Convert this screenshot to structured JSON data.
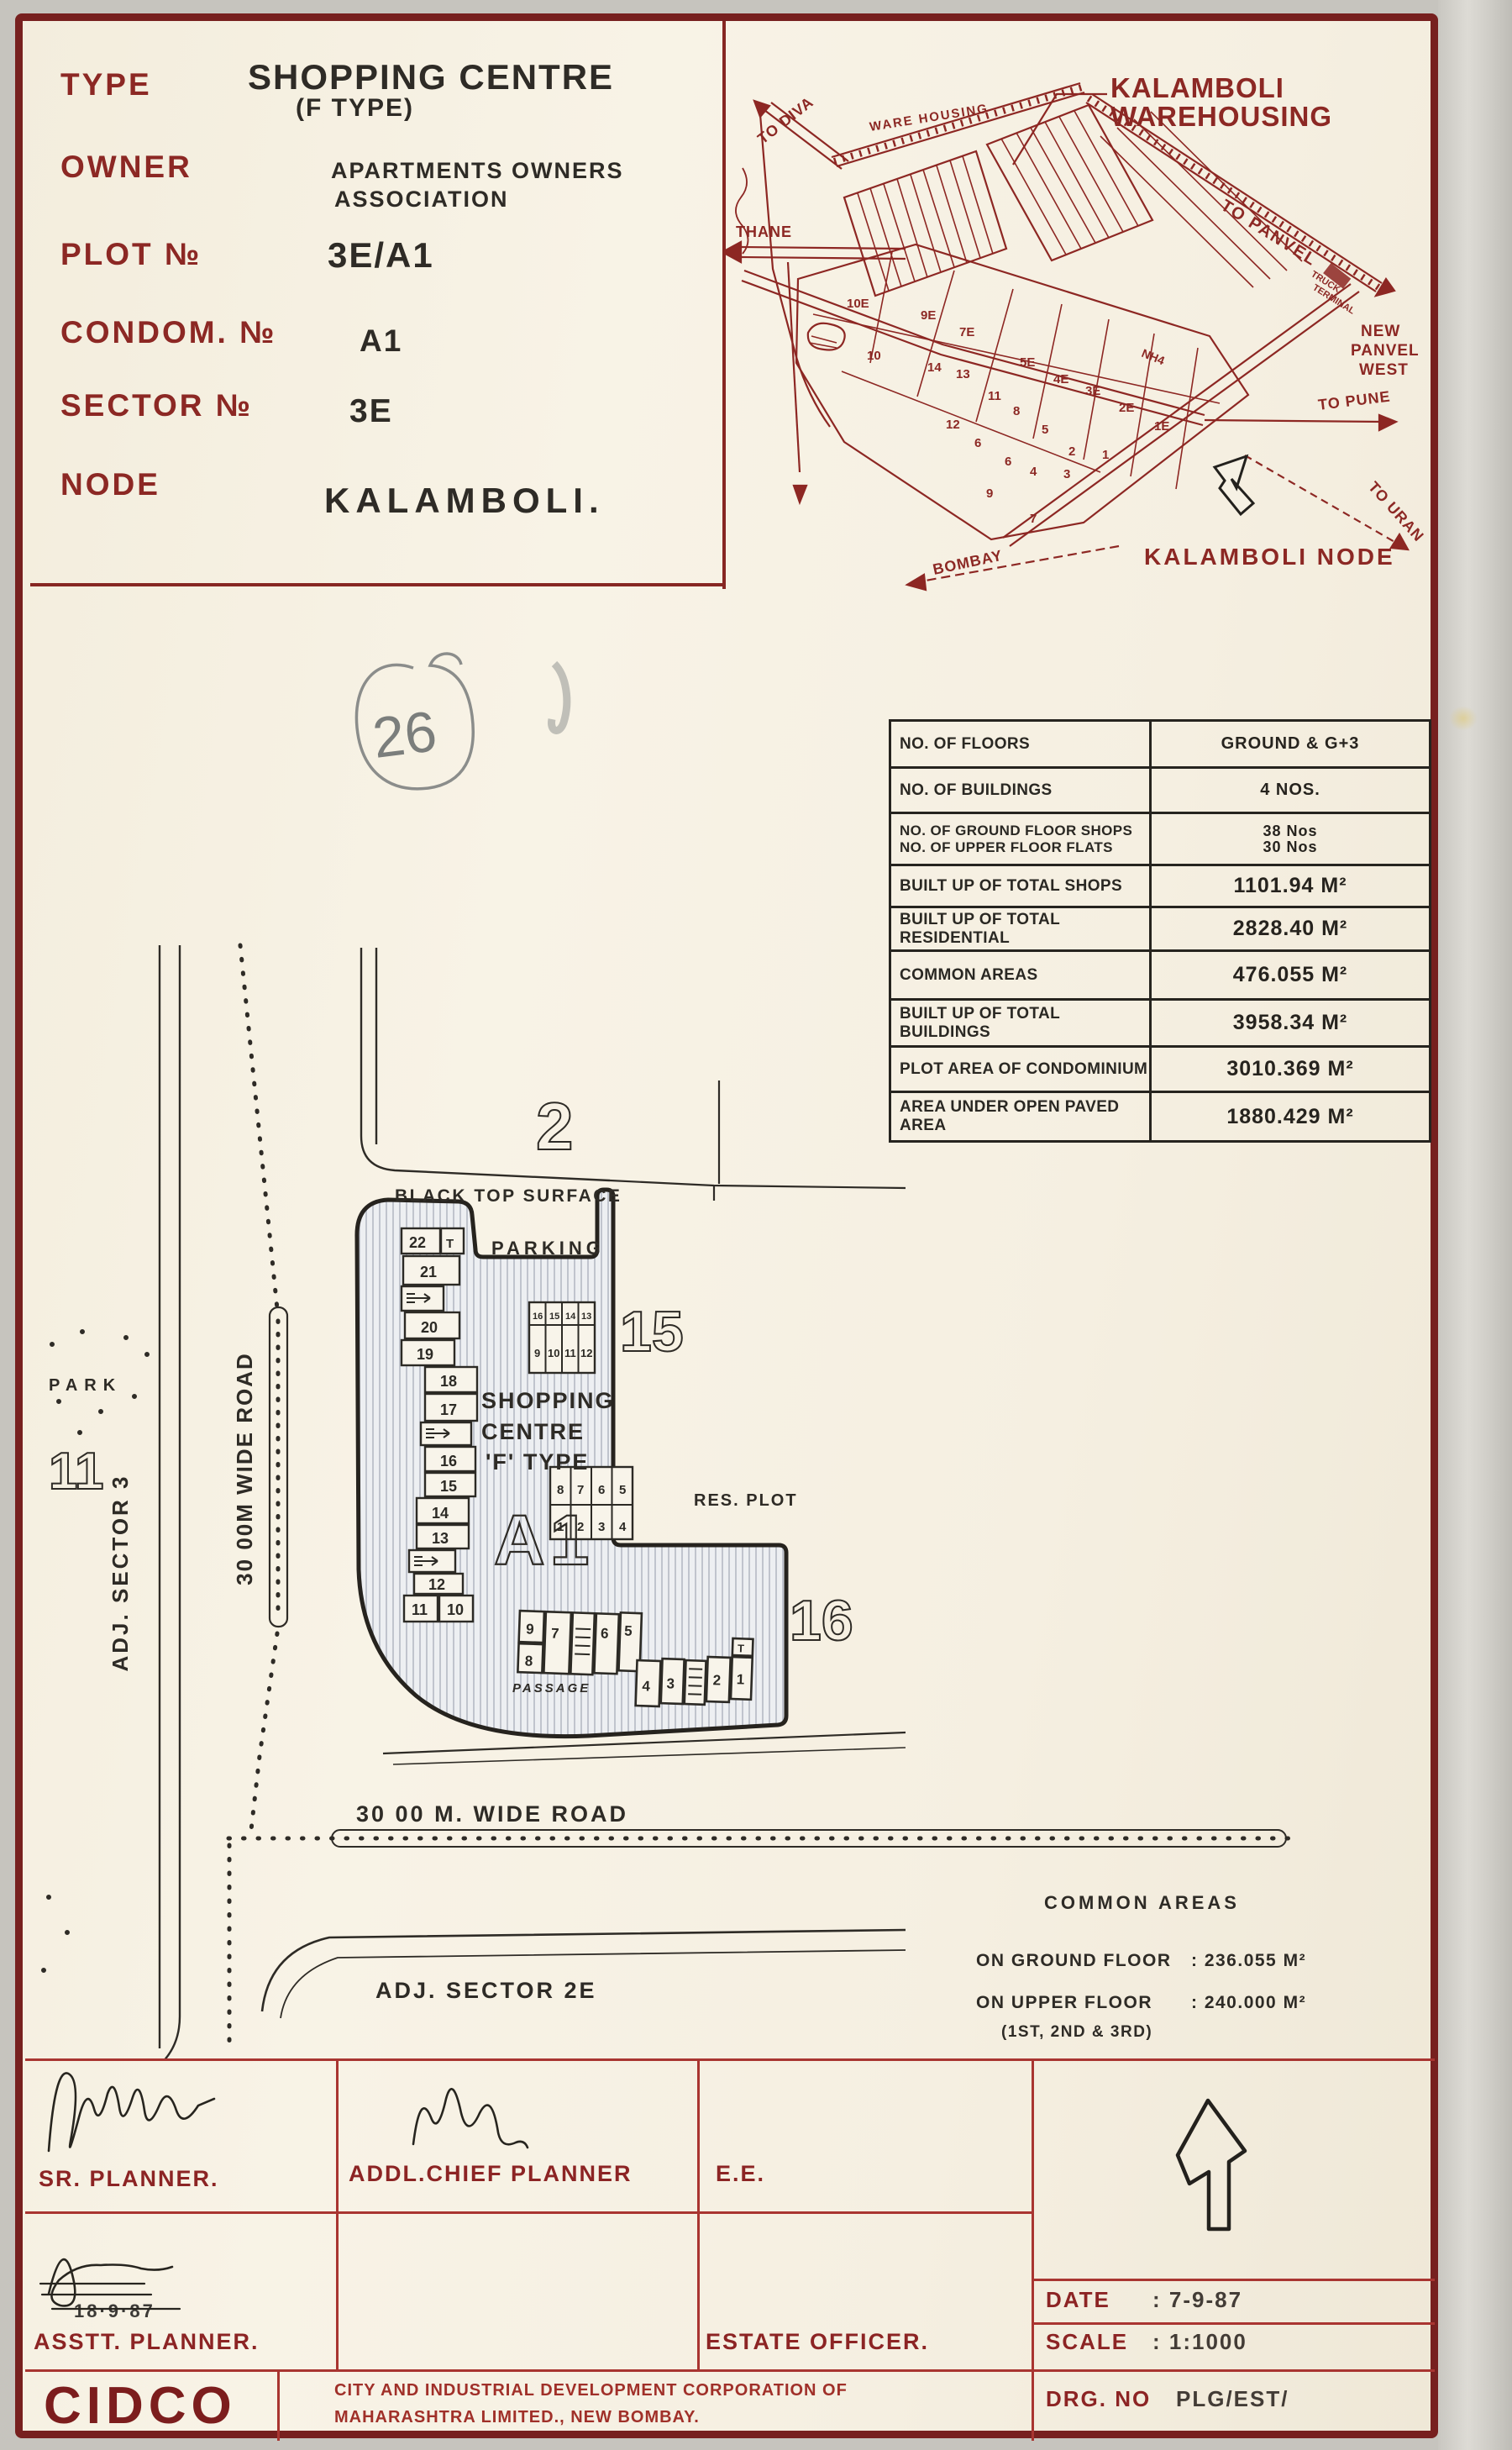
{
  "title_block": {
    "type_label": "TYPE",
    "type_value": "SHOPPING CENTRE",
    "type_value2": "(F TYPE)",
    "owner_label": "OWNER",
    "owner_value": "APARTMENTS OWNERS",
    "owner_value2": "ASSOCIATION",
    "plot_label": "PLOT №",
    "plot_value": "3E/A1",
    "condom_label": "CONDOM. №",
    "condom_value": "A1",
    "sector_label": "SECTOR №",
    "sector_value": "3E",
    "node_label": "NODE",
    "node_value": "KALAMBOLI."
  },
  "location_map": {
    "title1": "KALAMBOLI",
    "title2": "WAREHOUSING",
    "warehousing_label": "WARE HOUSING",
    "to_diva": "TO DIVA",
    "thane": "THANE",
    "to_panvel": "TO PANVEL",
    "truck1": "TRUCK",
    "truck2": "TERMINAL",
    "new_panvel1": "NEW",
    "new_panvel2": "PANVEL",
    "new_panvel3": "WEST",
    "nh4": "NH4",
    "to_pune": "TO PUNE",
    "to_uran": "TO URAN",
    "bombay": "BOMBAY",
    "node_label": "KALAMBOLI NODE",
    "plots": [
      "10E",
      "9E",
      "7E",
      "5E",
      "4E",
      "3E",
      "2E",
      "1E",
      "10",
      "14",
      "13",
      "11",
      "8",
      "12",
      "5",
      "6",
      "2",
      "1",
      "6",
      "4",
      "3",
      "9",
      "7"
    ]
  },
  "pencil_note": "26",
  "stats_table": {
    "rows": [
      {
        "label": "NO. OF FLOORS",
        "value": "GROUND & G+3"
      },
      {
        "label": "NO. OF BUILDINGS",
        "value": "4 NOS."
      },
      {
        "label": "NO. OF GROUND FLOOR SHOPS",
        "label2": "NO. OF UPPER FLOOR FLATS",
        "value": "38 Nos",
        "value2": "30 Nos"
      },
      {
        "label": "BUILT UP OF TOTAL SHOPS",
        "value": "1101.94 M²"
      },
      {
        "label": "BUILT UP OF TOTAL RESIDENTIAL",
        "value": "2828.40 M²"
      },
      {
        "label": "COMMON AREAS",
        "value": "476.055 M²"
      },
      {
        "label": "BUILT UP OF TOTAL BUILDINGS",
        "value": "3958.34 M²"
      },
      {
        "label": "PLOT AREA OF CONDOMINIUM",
        "value": "3010.369 M²"
      },
      {
        "label": "AREA UNDER OPEN PAVED AREA",
        "value": "1880.429 M²"
      }
    ]
  },
  "site_plan": {
    "plot2": "2",
    "plot15": "15",
    "plot16": "16",
    "plot11": "11",
    "black_top": "BLACK TOP SURFACE",
    "parking": "PARKING",
    "res_plot": "RES. PLOT",
    "park": "PARK",
    "adj_sector3": "ADJ. SECTOR 3",
    "road_w": "30 00M WIDE ROAD",
    "road_s": "30 00 M. WIDE ROAD",
    "adj_sector2e": "ADJ. SECTOR 2E",
    "centre1": "SHOPPING",
    "centre2": "CENTRE",
    "centre3": "'F' TYPE",
    "building": "A1",
    "passage": "PASSAGE",
    "t_label": "T",
    "left_shops": [
      "22",
      "21",
      "20",
      "19",
      "18",
      "17",
      "16",
      "15",
      "14",
      "13",
      "12",
      "11",
      "10"
    ],
    "grid1_top": [
      "16",
      "15",
      "14",
      "13"
    ],
    "grid1_bottom": [
      "9",
      "10",
      "11",
      "12"
    ],
    "grid2_top": [
      "8",
      "7",
      "6",
      "5"
    ],
    "grid2_bottom": [
      "1",
      "2",
      "3",
      "4"
    ],
    "block_a": [
      "9",
      "8",
      "7",
      "6",
      "5"
    ],
    "block_b": [
      "4",
      "3",
      "2",
      "1"
    ]
  },
  "common_areas": {
    "heading": "COMMON AREAS",
    "ground_label": "ON GROUND FLOOR",
    "ground_value": ": 236.055 M²",
    "upper_label": "ON UPPER FLOOR",
    "upper_value": ": 240.000 M²",
    "upper_note": "(1ST, 2ND & 3RD)"
  },
  "approvals": {
    "sr_planner": "SR. PLANNER.",
    "addl_chief_planner": "ADDL.CHIEF PLANNER",
    "ee": "E.E.",
    "asstt_planner": "ASSTT. PLANNER.",
    "asstt_date": "18·9·87",
    "estate_officer": "ESTATE OFFICER.",
    "date_label": "DATE",
    "date_value": ":  7-9-87",
    "scale_label": "SCALE",
    "scale_value": ":  1:1000",
    "drg_label": "DRG. NO",
    "drg_value": "PLG/EST/"
  },
  "footer": {
    "org_short": "CIDCO",
    "org_line1": "CITY AND INDUSTRIAL DEVELOPMENT CORPORATION OF",
    "org_line2": "MAHARASHTRA LIMITED., NEW BOMBAY."
  }
}
